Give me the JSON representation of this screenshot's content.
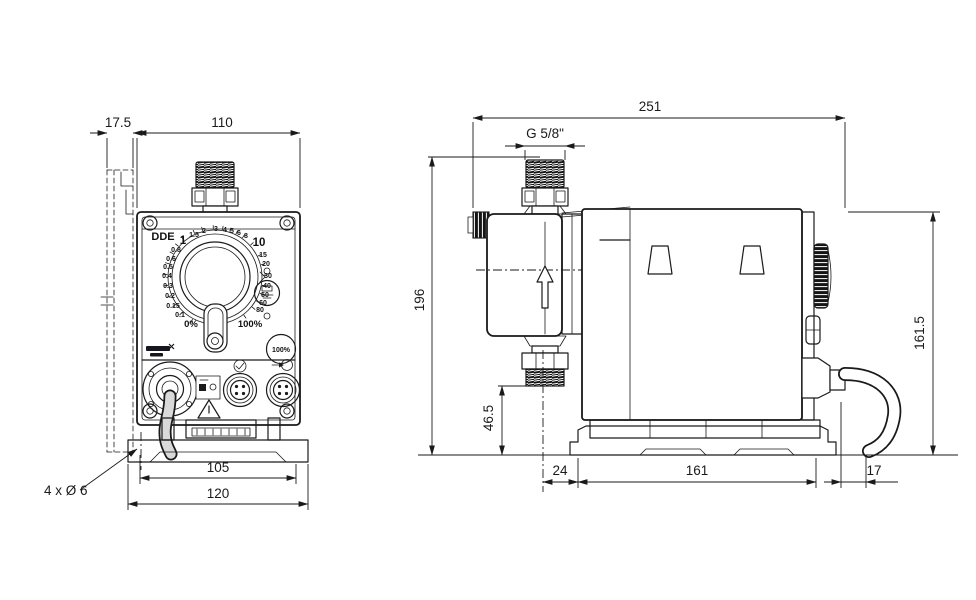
{
  "product": {
    "model": "DDE"
  },
  "front_view": {
    "dimensions": {
      "bracket_depth": "17.5",
      "width": "110",
      "mounting_hole_span": "105",
      "base_width": "120",
      "mounting_holes_note": "4 x Ø 6"
    },
    "control_panel": {
      "model_label": "DDE",
      "dial_scale_left": [
        "1",
        "0.8",
        "0.6",
        "0.5",
        "0.4",
        "0.3",
        "0.2",
        "0.15",
        "0.1"
      ],
      "dial_scale_min": "0%",
      "dial_scale_top": [
        "1.5",
        "2",
        "3",
        "4",
        "5",
        "6",
        "8"
      ],
      "dial_scale_right": [
        "10",
        "15",
        "20",
        "30",
        "40",
        "50",
        "60",
        "80"
      ],
      "dial_scale_max": "100%",
      "prime_button_label": "100%"
    },
    "icons": [
      "grundfos-logo",
      "deaeration-button-icon",
      "status-led",
      "warning-triangle-icon",
      "level-input-icon",
      "pulse-input-icon",
      "signal-connector-icon",
      "power-cable"
    ]
  },
  "side_view": {
    "dimensions": {
      "total_depth": "251",
      "connection_thread": "G 5/8\"",
      "total_height": "196",
      "valve_clearance_height": "46.5",
      "housing_height": "161.5",
      "front_overhang": "24",
      "base_length": "161",
      "rear_overhang": "17"
    },
    "icons": [
      "flow-direction-arrow-icon",
      "click-wheel",
      "cable-gland",
      "power-cable"
    ]
  },
  "colors": {
    "line": "#1a1a1a",
    "cable_fill": "#d9d9d9",
    "background": "#ffffff"
  }
}
